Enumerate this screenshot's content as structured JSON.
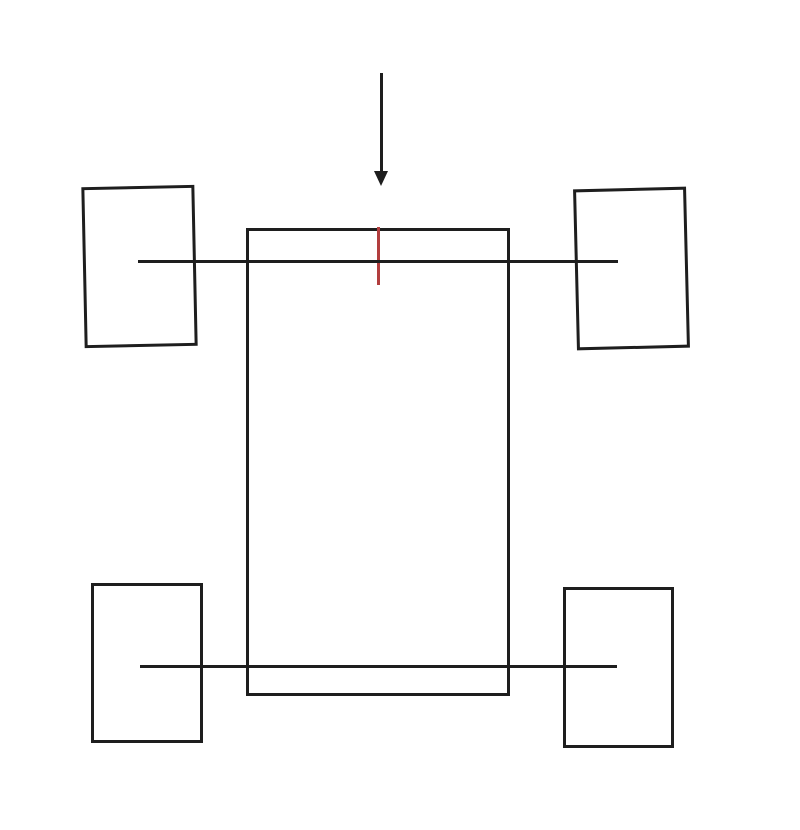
{
  "meta": {
    "description": "Hand-drawn vehicle chassis top-view sketch: rectangular body, two axles through four wheel rectangles, downward force arrow above, red offset tick on top edge",
    "canvas": {
      "width": 800,
      "height": 830,
      "background": "#ffffff"
    }
  },
  "colors": {
    "ink": "#1e1e1e",
    "marker_red": "#b23e3e"
  },
  "shapes": [
    {
      "name": "chassis-body",
      "type": "rect",
      "x": 246,
      "y": 228,
      "w": 264,
      "h": 468,
      "stroke": 3,
      "color": "ink",
      "rotate": 0
    },
    {
      "name": "red-offset-mark",
      "type": "line",
      "x": 377,
      "y": 227,
      "w": 3,
      "h": 58,
      "color": "marker_red"
    },
    {
      "name": "front-axle",
      "type": "line",
      "x": 138,
      "y": 260,
      "w": 480,
      "h": 3,
      "color": "ink"
    },
    {
      "name": "rear-axle",
      "type": "line",
      "x": 140,
      "y": 665,
      "w": 477,
      "h": 3,
      "color": "ink"
    },
    {
      "name": "wheel-front-left",
      "type": "rect",
      "x": 83,
      "y": 186,
      "w": 113,
      "h": 161,
      "stroke": 3,
      "color": "ink",
      "rotate": -1.2
    },
    {
      "name": "wheel-front-right",
      "type": "rect",
      "x": 575,
      "y": 188,
      "w": 113,
      "h": 161,
      "stroke": 3,
      "color": "ink",
      "rotate": -1.4
    },
    {
      "name": "wheel-rear-left",
      "type": "rect",
      "x": 91,
      "y": 583,
      "w": 112,
      "h": 160,
      "stroke": 3,
      "color": "ink",
      "rotate": 0
    },
    {
      "name": "wheel-rear-right",
      "type": "rect",
      "x": 563,
      "y": 587,
      "w": 111,
      "h": 161,
      "stroke": 3,
      "color": "ink",
      "rotate": 0
    },
    {
      "name": "force-arrow-shaft",
      "type": "line",
      "x": 380,
      "y": 73,
      "w": 3,
      "h": 100,
      "color": "ink"
    },
    {
      "name": "force-arrow-head",
      "type": "triangle-down",
      "x": 374,
      "y": 171,
      "w": 15,
      "h": 15,
      "color": "ink"
    }
  ]
}
